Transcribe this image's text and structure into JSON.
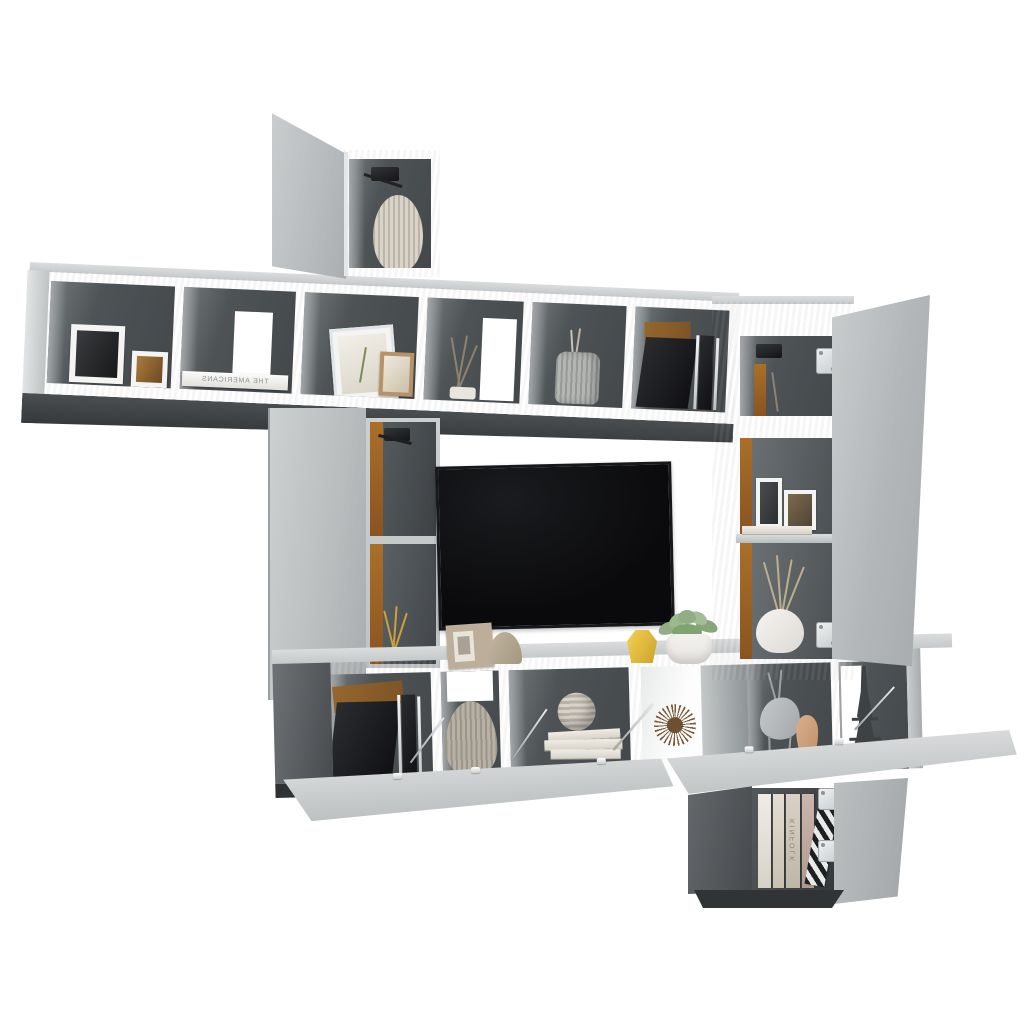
{
  "image": {
    "type": "product-photo",
    "subject": "10-piece wall-mounted TV media wall unit with open cube shelves, drop-down doors and side cabinets",
    "finish": "concrete grey",
    "background": "white studio backdrop"
  },
  "theme": {
    "bgWhite": "#ffffff",
    "concreteLight": "#cbcfd0",
    "concreteMid": "#b7bbbd",
    "concreteTop": "#dadcdd",
    "interiorDark": "#4e5356",
    "underside": "#36393b",
    "amberBack": "#8a5420",
    "amberLight": "#a96f2a",
    "tvBlack": "#0a0a0c",
    "accentYellow": "#e3bc3f",
    "succulentGreen": "#8fae85",
    "potWhite": "#e6e3df",
    "vaseCream": "#d8d1c5",
    "vaseGrey": "#b3aca0",
    "kraftBrown": "#96672f",
    "blackBox": "#101013",
    "chrome": "#c7cbcd"
  },
  "text": {
    "book_spine_top_row": "THE AMERICANS",
    "book_spine_bottom_cabinet": "KINFOLK"
  },
  "decor_items": [
    "ribbed ceramic vase in top cabinet",
    "black-and-white botanical photo frames",
    "flat white coffee-table book",
    "leaning picture frames",
    "dried twig decoration",
    "grey ceramic utensil jar",
    "black folders with kraft box",
    "flat-screen TV",
    "beige photo frame and abstract sculpture",
    "faceted yellow vase",
    "succulent in white pot",
    "black media boxes",
    "large ribbed stoneware vase",
    "striped sphere ornament on white books",
    "spiky wooden ornament",
    "abstract deer figurine with bud vase",
    "Eiffel Tower miniature",
    "magazines and striped book in bottom cabinet"
  ],
  "hardware": [
    "soft-close door hinges",
    "flap stay support arms"
  ]
}
